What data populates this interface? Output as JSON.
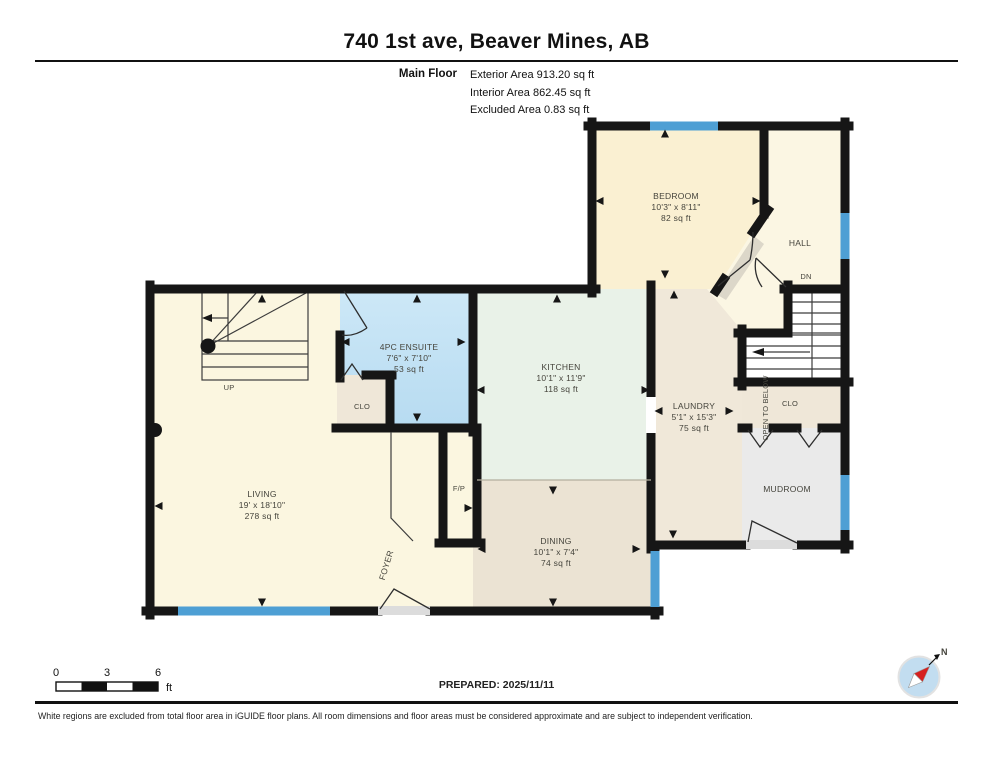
{
  "header": {
    "title": "740 1st ave, Beaver Mines, AB",
    "floor_label": "Main Floor",
    "stats": [
      "Exterior Area 913.20 sq ft",
      "Interior Area 862.45 sq ft",
      "Excluded Area 0.83 sq ft"
    ]
  },
  "rooms": {
    "bedroom": {
      "name": "BEDROOM",
      "dims": "10'3\" x 8'11\"",
      "area": "82 sq ft"
    },
    "hall": {
      "name": "HALL"
    },
    "kitchen": {
      "name": "KITCHEN",
      "dims": "10'1\" x 11'9\"",
      "area": "118 sq ft"
    },
    "ensuite": {
      "name": "4PC ENSUITE",
      "dims": "7'6\" x 7'10\"",
      "area": "53 sq ft"
    },
    "living": {
      "name": "LIVING",
      "dims": "19' x 18'10\"",
      "area": "278 sq ft"
    },
    "dining": {
      "name": "DINING",
      "dims": "10'1\" x 7'4\"",
      "area": "74 sq ft"
    },
    "laundry": {
      "name": "LAUNDRY",
      "dims": "5'1\" x 15'3\"",
      "area": "75 sq ft"
    },
    "mudroom": {
      "name": "MUDROOM"
    },
    "foyer": {
      "name": "FOYER"
    },
    "clo_left": {
      "name": "CLO"
    },
    "clo_right": {
      "name": "CLO"
    },
    "fireplace": {
      "name": "F/P"
    },
    "stairs_up": {
      "name": "UP"
    },
    "stairs_dn": {
      "name": "DN"
    },
    "open_below": {
      "name": "OPEN TO BELOW"
    }
  },
  "scale": {
    "ticks": [
      "0",
      "3",
      "6"
    ],
    "unit": "ft"
  },
  "footer": {
    "prepared": "PREPARED: 2025/11/11",
    "compass_label": "N",
    "disclaimer": "White regions are excluded from total floor area in iGUIDE floor plans. All room dimensions and floor areas must be considered approximate and are subject to independent verification."
  },
  "colors": {
    "wall": "#161616",
    "window": "#4e9fd4",
    "living_fill": "#fbf6e0",
    "bedroom_fill": "#faf0d2",
    "kitchen_fill": "#e9f2e8",
    "dining_fill": "#ebe3d3",
    "laundry_fill": "#f0e8d9",
    "ensuite_fill": "#c2e2f3",
    "mudroom_fill": "#eaeaea",
    "stairs_fill": "#e4e4e4",
    "compass_red": "#d6201f",
    "compass_circle": "#c2ddf0"
  }
}
